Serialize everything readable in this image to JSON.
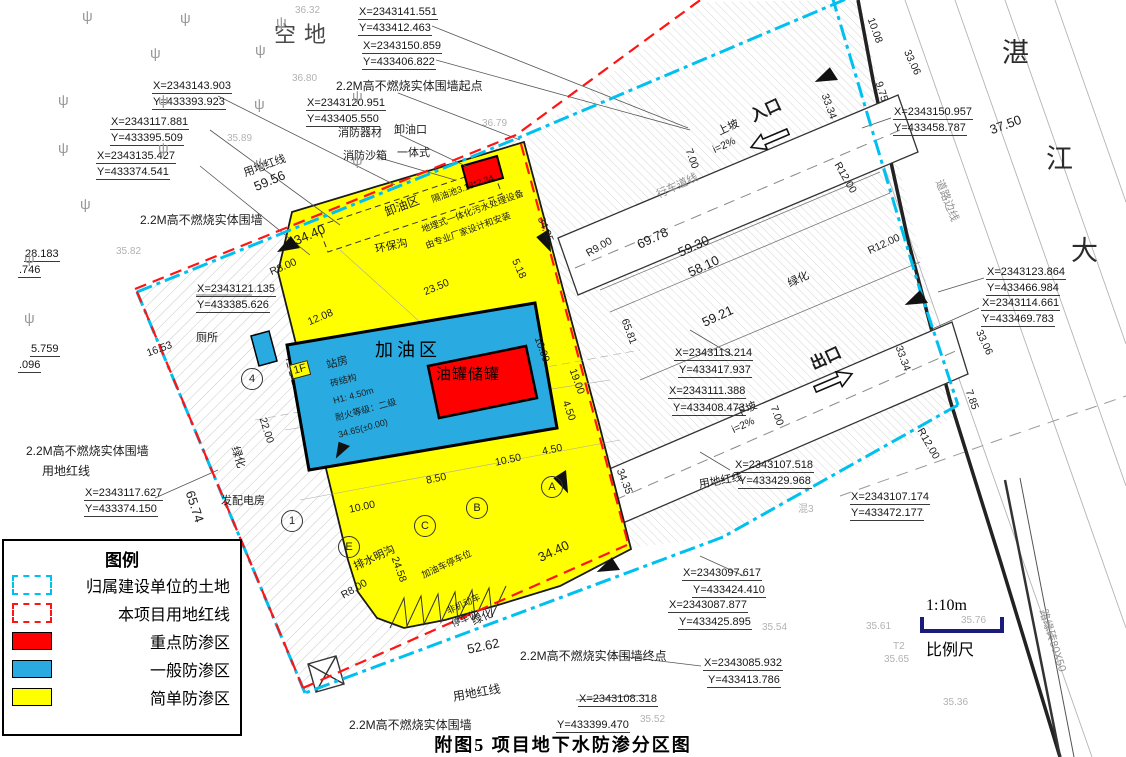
{
  "figure": {
    "title": "附图5  项目地下水防渗分区图",
    "scale_bar": {
      "ratio": "1:10m",
      "label": "比例尺"
    }
  },
  "legend": {
    "title": "图例",
    "items": [
      {
        "swatch": "cyan-dashed",
        "label": "归属建设单位的土地"
      },
      {
        "swatch": "red-dashed",
        "label": "本项目用地红线"
      },
      {
        "swatch": "red-fill",
        "label": "重点防渗区"
      },
      {
        "swatch": "blue-fill",
        "label": "一般防渗区"
      },
      {
        "swatch": "yellow-fill",
        "label": "简单防渗区"
      }
    ]
  },
  "colors": {
    "simple_zone": "#FFFF00",
    "general_zone": "#29ABE2",
    "key_zone": "#FE0000",
    "granted_land_boundary": "#00C0F0",
    "project_red_line": "#FF1414",
    "scale_bar": "#1B1B7A"
  },
  "zones": {
    "key_zone_label": "油罐储罐",
    "general_zone_label": "加油区",
    "simple_zone_features": [
      "卸油区",
      "环保沟",
      "排水明沟",
      "站房"
    ]
  },
  "plan": {
    "tree_glyph": "ψ",
    "trees": [
      [
        82,
        8
      ],
      [
        180,
        10
      ],
      [
        276,
        14
      ],
      [
        255,
        42
      ],
      [
        150,
        45
      ],
      [
        58,
        92
      ],
      [
        158,
        92
      ],
      [
        254,
        96
      ],
      [
        352,
        88
      ],
      [
        58,
        140
      ],
      [
        158,
        140
      ],
      [
        255,
        155
      ],
      [
        352,
        152
      ],
      [
        80,
        196
      ],
      [
        24,
        250
      ],
      [
        24,
        310
      ]
    ],
    "circles": [
      {
        "t": "1",
        "x": 291,
        "y": 520
      },
      {
        "t": "4",
        "x": 251,
        "y": 378
      },
      {
        "t": "A",
        "x": 551,
        "y": 486
      },
      {
        "t": "B",
        "x": 476,
        "y": 507
      },
      {
        "t": "C",
        "x": 424,
        "y": 525
      },
      {
        "t": "E",
        "x": 348,
        "y": 546
      }
    ],
    "labels": [
      [
        "X=2343141.551",
        358,
        6,
        0,
        "coord"
      ],
      [
        "Y=433412.463",
        358,
        22,
        0,
        "coord"
      ],
      [
        "X=2343150.859",
        362,
        40,
        0,
        "coord"
      ],
      [
        "Y=433406.822",
        362,
        56,
        0,
        "coord"
      ],
      [
        "X=2343143.903",
        152,
        80,
        0,
        "coord"
      ],
      [
        "Y=433393.923",
        152,
        96,
        0,
        "coord"
      ],
      [
        "2.2M高不燃烧实体围墙起点",
        336,
        80,
        0,
        "cn"
      ],
      [
        "X=2343120.951",
        306,
        97,
        0,
        "coord"
      ],
      [
        "Y=433405.550",
        306,
        113,
        0,
        "coord"
      ],
      [
        "X=2343117.881",
        110,
        116,
        0,
        "coord"
      ],
      [
        "Y=433395.509",
        110,
        132,
        0,
        "coord"
      ],
      [
        "X=2343135.427",
        96,
        150,
        0,
        "coord"
      ],
      [
        "Y=433374.541",
        96,
        166,
        0,
        "coord"
      ],
      [
        "空地",
        274,
        22,
        0,
        "big"
      ],
      [
        "湛",
        1002,
        38,
        0,
        "big2"
      ],
      [
        "江",
        1046,
        144,
        0,
        "big2"
      ],
      [
        "大",
        1071,
        236,
        0,
        "big2"
      ],
      [
        "消防器材",
        338,
        127,
        0,
        "cn11"
      ],
      [
        "卸油口",
        394,
        124,
        0,
        "cn11"
      ],
      [
        "一体式",
        397,
        147,
        0,
        "cn11"
      ],
      [
        "消防沙箱",
        343,
        150,
        0,
        "cn11"
      ],
      [
        "用地红线",
        242,
        168,
        -20,
        "cn11"
      ],
      [
        "59.56",
        252,
        181,
        -23,
        "dim13"
      ],
      [
        "2.2M高不燃烧实体围墙",
        140,
        214,
        0,
        "cn"
      ],
      [
        "28.183",
        24,
        248,
        0,
        "coord"
      ],
      [
        ".746",
        18,
        264,
        0,
        "coord"
      ],
      [
        "X=2343121.135",
        196,
        283,
        0,
        "coord"
      ],
      [
        "Y=433385.626",
        196,
        299,
        0,
        "coord"
      ],
      [
        "X=2343150.957",
        893,
        106,
        0,
        "coord"
      ],
      [
        "Y=433458.787",
        893,
        122,
        0,
        "coord"
      ],
      [
        "37.50",
        988,
        124,
        -20,
        "dim13"
      ],
      [
        "10.08",
        876,
        16,
        70,
        "dim"
      ],
      [
        "33.06",
        912,
        48,
        65,
        "dim"
      ],
      [
        "9.75",
        884,
        80,
        72,
        "dim"
      ],
      [
        "33.34",
        830,
        92,
        70,
        "dim"
      ],
      [
        "R12.00",
        842,
        160,
        60,
        "dim"
      ],
      [
        "道路边线",
        944,
        178,
        68,
        "gray11"
      ],
      [
        "R12.00",
        866,
        246,
        -25,
        "dim"
      ],
      [
        "X=2343123.864",
        986,
        266,
        0,
        "coord"
      ],
      [
        "Y=433466.984",
        986,
        282,
        0,
        "coord"
      ],
      [
        "X=2343114.661",
        981,
        297,
        0,
        "coord"
      ],
      [
        "Y=433469.783",
        981,
        313,
        0,
        "coord"
      ],
      [
        "33.06",
        984,
        328,
        65,
        "dim"
      ],
      [
        "33.34",
        904,
        344,
        70,
        "dim"
      ],
      [
        "7.85",
        974,
        388,
        70,
        "dim"
      ],
      [
        "R12.00",
        925,
        426,
        60,
        "dim"
      ],
      [
        "5.759",
        30,
        343,
        0,
        "coord"
      ],
      [
        ".096",
        18,
        359,
        0,
        "coord"
      ],
      [
        "厕所",
        196,
        332,
        0,
        "cn11"
      ],
      [
        "16.53",
        145,
        348,
        -20,
        "dim"
      ],
      [
        "卸油区",
        383,
        207,
        -21,
        "cn"
      ],
      [
        "隔油池3.18*2.34",
        430,
        195,
        -20,
        "tiny"
      ],
      [
        "地埋式一体化污水处理设备",
        420,
        225,
        -20,
        "tiny"
      ],
      [
        "由专业厂家设计和安装",
        424,
        241,
        -20,
        "tiny"
      ],
      [
        "环保沟",
        374,
        244,
        -12,
        "cn11"
      ],
      [
        "34.40",
        292,
        235,
        -23,
        "dim13"
      ],
      [
        "R8.00",
        268,
        267,
        -23,
        "dim"
      ],
      [
        "12.08",
        306,
        317,
        -23,
        "dim"
      ],
      [
        "23.50",
        422,
        287,
        -23,
        "dim"
      ],
      [
        "5.18",
        520,
        257,
        65,
        "dim"
      ],
      [
        "34.35",
        546,
        215,
        68,
        "dim"
      ],
      [
        "加油区",
        375,
        340,
        0,
        "zoneblue"
      ],
      [
        "油罐储罐",
        436,
        366,
        0,
        "zonered"
      ],
      [
        "10.00",
        543,
        335,
        70,
        "dim"
      ],
      [
        "19.00",
        578,
        367,
        70,
        "dim"
      ],
      [
        "4.50",
        571,
        399,
        70,
        "dim"
      ],
      [
        "34.35",
        625,
        467,
        68,
        "dim"
      ],
      [
        "4.50",
        541,
        446,
        -12,
        "dim"
      ],
      [
        "10.50",
        494,
        457,
        -12,
        "dim"
      ],
      [
        "8.50",
        425,
        475,
        -12,
        "dim"
      ],
      [
        "10.00",
        348,
        504,
        -12,
        "dim"
      ],
      [
        "1F",
        289,
        365,
        -15,
        "boxed"
      ],
      [
        "站房",
        325,
        360,
        -15,
        "cn11"
      ],
      [
        "砖结构",
        329,
        379,
        -15,
        "tiny"
      ],
      [
        "H1: 4.50m",
        332,
        396,
        -15,
        "tiny"
      ],
      [
        "耐火等级：二级",
        334,
        413,
        -15,
        "tiny"
      ],
      [
        "34.65(±0.00)",
        337,
        430,
        -15,
        "tiny"
      ],
      [
        "发配电房",
        221,
        495,
        0,
        "cn11"
      ],
      [
        "22.00",
        268,
        416,
        72,
        "dim"
      ],
      [
        "绿化",
        240,
        445,
        72,
        "cn11"
      ],
      [
        "65.74",
        196,
        489,
        72,
        "dim13"
      ],
      [
        "2.2M高不燃烧实体围墙",
        26,
        445,
        0,
        "cn"
      ],
      [
        "用地红线",
        42,
        465,
        0,
        "cn"
      ],
      [
        "X=2343117.627",
        84,
        487,
        0,
        "coord"
      ],
      [
        "Y=433374.150",
        84,
        503,
        0,
        "coord"
      ],
      [
        "排水明沟",
        352,
        562,
        -25,
        "cn11"
      ],
      [
        "R8.00",
        339,
        591,
        -30,
        "dim"
      ],
      [
        "24.58",
        400,
        555,
        70,
        "dim"
      ],
      [
        "加油车停车位",
        420,
        571,
        -25,
        "tiny"
      ],
      [
        "非机动车",
        445,
        607,
        -25,
        "tiny"
      ],
      [
        "停车位",
        450,
        620,
        -25,
        "tiny"
      ],
      [
        "34.40",
        536,
        552,
        -25,
        "dim13"
      ],
      [
        "52.62",
        466,
        643,
        -12,
        "dim13"
      ],
      [
        "绿化",
        470,
        617,
        -25,
        "cn11"
      ],
      [
        "2.2M高不燃烧实体围墙终点",
        520,
        650,
        0,
        "cn"
      ],
      [
        "用地红线",
        452,
        691,
        -10,
        "cn"
      ],
      [
        "X=2343108.318",
        578,
        693,
        0,
        "coord"
      ],
      [
        "2.2M高不燃烧实体围墙",
        349,
        719,
        0,
        "cn"
      ],
      [
        "Y=433399.470",
        556,
        719,
        0,
        "coord"
      ],
      [
        "X=2343113.214",
        674,
        347,
        0,
        "coord"
      ],
      [
        "Y=433417.937",
        678,
        364,
        0,
        "coord"
      ],
      [
        "X=2343111.388",
        668,
        385,
        0,
        "coord"
      ],
      [
        "Y=433408.473",
        672,
        402,
        0,
        "coord"
      ],
      [
        "下坡",
        734,
        409,
        -25,
        "cn11"
      ],
      [
        "i=2%",
        730,
        425,
        -25,
        "dim"
      ],
      [
        "出口",
        808,
        358,
        -25,
        "bigcn"
      ],
      [
        "7.00",
        779,
        404,
        70,
        "dim"
      ],
      [
        "X=2343107.518",
        734,
        459,
        0,
        "coord"
      ],
      [
        "Y=433429.968",
        738,
        475,
        0,
        "coord"
      ],
      [
        "用地红线",
        698,
        479,
        -10,
        "cn11"
      ],
      [
        "X=2343107.174",
        850,
        491,
        0,
        "coord"
      ],
      [
        "Y=433472.177",
        850,
        507,
        0,
        "coord"
      ],
      [
        "混3",
        798,
        504,
        0,
        "faint"
      ],
      [
        "X=2343097.617",
        682,
        567,
        0,
        "coord"
      ],
      [
        "Y=433424.410",
        692,
        584,
        0,
        "coord"
      ],
      [
        "X=2343087.877",
        668,
        599,
        0,
        "coord"
      ],
      [
        "Y=433425.895",
        678,
        616,
        0,
        "coord"
      ],
      [
        "X=2343085.932",
        703,
        657,
        0,
        "coord"
      ],
      [
        "Y=433413.786",
        707,
        674,
        0,
        "coord"
      ],
      [
        "上坡",
        716,
        127,
        -25,
        "cn11"
      ],
      [
        "i=2%",
        711,
        145,
        -25,
        "dim"
      ],
      [
        "入口",
        748,
        110,
        -25,
        "bigcn"
      ],
      [
        "7.00",
        694,
        147,
        70,
        "dim"
      ],
      [
        "行车道线",
        655,
        190,
        -25,
        "gray11"
      ],
      [
        "69.78",
        635,
        239,
        -25,
        "dim13"
      ],
      [
        "59.30",
        676,
        247,
        -25,
        "dim13"
      ],
      [
        "58.10",
        686,
        267,
        -25,
        "dim13"
      ],
      [
        "59.21",
        700,
        317,
        -25,
        "dim13"
      ],
      [
        "65.81",
        630,
        317,
        70,
        "dim"
      ],
      [
        "R9.00",
        584,
        249,
        -30,
        "dim"
      ],
      [
        "绿化",
        786,
        279,
        -25,
        "cn11"
      ],
      [
        "路缘砖80X50",
        1048,
        608,
        72,
        "gray11"
      ],
      [
        "36.32",
        295,
        5,
        0,
        "faint"
      ],
      [
        "36.80",
        292,
        73,
        0,
        "faint"
      ],
      [
        "35.89",
        227,
        133,
        0,
        "faint"
      ],
      [
        "36.79",
        482,
        118,
        0,
        "faint"
      ],
      [
        "35.82",
        116,
        246,
        0,
        "faint"
      ],
      [
        "35.54",
        762,
        622,
        0,
        "faint"
      ],
      [
        "35.61",
        866,
        621,
        0,
        "faint"
      ],
      [
        "T2",
        893,
        641,
        0,
        "faint"
      ],
      [
        "35.65",
        884,
        654,
        0,
        "faint"
      ],
      [
        "35.76",
        961,
        615,
        0,
        "faint"
      ],
      [
        "35.52",
        640,
        714,
        0,
        "faint"
      ],
      [
        "35.36",
        943,
        697,
        0,
        "faint"
      ]
    ]
  }
}
